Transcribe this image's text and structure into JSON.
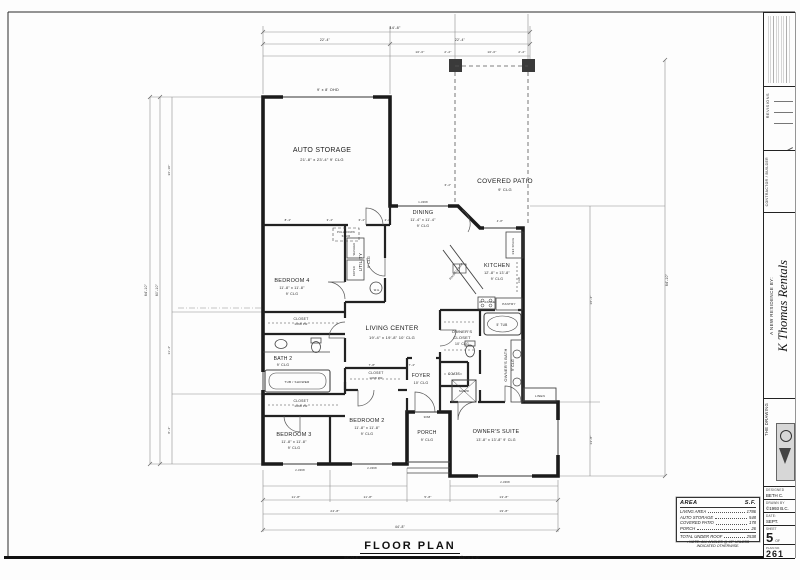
{
  "sheet": {
    "title": "FLOOR PLAN",
    "scale_label": "SCALE:",
    "scale_value": "1/4\" = 1'-0\""
  },
  "title_block": {
    "revisions_label": "REVISIONS",
    "contractor_label": "CONTRACTOR / BUILDER",
    "residence_by": "A NEW RESIDENCE BY:",
    "client_name": "K Thomas Rentals",
    "firm_label_line1": "THE",
    "firm_label_line2": "DRAWING",
    "designed_label": "DESIGNED",
    "designed_value": "BETH C.",
    "drawn_label": "DRAWN BY",
    "drawn_value": "©1993 B.C.",
    "date_label": "DATE:",
    "date_value": "SEPT.",
    "sheet_label": "SHEET",
    "sheet_number": "5",
    "sheet_of": "OF",
    "plan_no_label": "PLAN NO.",
    "plan_no_value": "261"
  },
  "area_table": {
    "title": "AREA",
    "unit": "S.F.",
    "rows": [
      {
        "label": "LIVING AREA",
        "value": "1786"
      },
      {
        "label": "AUTO STORAGE",
        "value": "548"
      },
      {
        "label": "COVERED PATIO",
        "value": "178"
      },
      {
        "label": "PORCH",
        "value": "26"
      },
      {
        "label": "TOTAL UNDER ROOF",
        "value": "2538",
        "total": true
      }
    ],
    "note_line1": "• NOTE:  ALL ANGLES @ 45° UNLESS",
    "note_line2": "INDICATED OTHERWISE."
  },
  "plan": {
    "labels": [
      {
        "t": "AUTO STORAGE",
        "x": 322,
        "y": 152,
        "s": 7
      },
      {
        "t": "21'-8\" x 23'-4\"      9' CLG",
        "x": 322,
        "y": 161,
        "s": 4
      },
      {
        "t": "9' x 8' OHD",
        "x": 328,
        "y": 91,
        "s": 3.8
      },
      {
        "t": "COVERED PATIO",
        "x": 505,
        "y": 183,
        "s": 6.5
      },
      {
        "t": "9' CLG",
        "x": 505,
        "y": 191,
        "s": 4
      },
      {
        "t": "DINING",
        "x": 423,
        "y": 214,
        "s": 5.5
      },
      {
        "t": "11'-4\" x 11'-4\"",
        "x": 423,
        "y": 221,
        "s": 3.6
      },
      {
        "t": "9' CLG",
        "x": 423,
        "y": 227,
        "s": 3.6
      },
      {
        "t": "KITCHEN",
        "x": 497,
        "y": 267,
        "s": 5.5
      },
      {
        "t": "12'-8\" x 13'-8\"",
        "x": 497,
        "y": 274,
        "s": 3.6
      },
      {
        "t": "9' CLG",
        "x": 497,
        "y": 280,
        "s": 3.6
      },
      {
        "t": "BEDROOM 4",
        "x": 292,
        "y": 282,
        "s": 5.5
      },
      {
        "t": "11'-8\" x 11'-8\"",
        "x": 292,
        "y": 289,
        "s": 3.6
      },
      {
        "t": "9' CLG",
        "x": 292,
        "y": 295,
        "s": 3.6
      },
      {
        "t": "UTILITY",
        "x": 362,
        "y": 262,
        "s": 4.5,
        "r": -90
      },
      {
        "t": "9' CLG",
        "x": 370,
        "y": 262,
        "s": 3.4,
        "r": -90
      },
      {
        "t": "PULL-DOWN",
        "x": 346,
        "y": 233,
        "s": 2.6
      },
      {
        "t": "STAIR",
        "x": 346,
        "y": 237,
        "s": 2.6
      },
      {
        "t": "LIVING CENTER",
        "x": 392,
        "y": 330,
        "s": 6.5
      },
      {
        "t": "19'-4\" x 19'-8\"      10' CLG",
        "x": 392,
        "y": 339,
        "s": 4
      },
      {
        "t": "OWNER'S",
        "x": 462,
        "y": 333,
        "s": 4
      },
      {
        "t": "CLOSET",
        "x": 462,
        "y": 339,
        "s": 4
      },
      {
        "t": "10' CLG",
        "x": 462,
        "y": 345,
        "s": 3.4
      },
      {
        "t": "OWNER'S BATH",
        "x": 507,
        "y": 365,
        "s": 4,
        "r": -90
      },
      {
        "t": "9' CLG",
        "x": 514,
        "y": 365,
        "s": 3.4,
        "r": -90
      },
      {
        "t": "5' TUB",
        "x": 502,
        "y": 326,
        "s": 3.2
      },
      {
        "t": "SHWR",
        "x": 464,
        "y": 392,
        "s": 3
      },
      {
        "t": "LINEN",
        "x": 540,
        "y": 397,
        "s": 3
      },
      {
        "t": "BATH 2",
        "x": 283,
        "y": 360,
        "s": 5
      },
      {
        "t": "9' CLG",
        "x": 283,
        "y": 366,
        "s": 3.6
      },
      {
        "t": "TUB / SHOWER",
        "x": 297,
        "y": 383,
        "s": 3
      },
      {
        "t": "CLOSET",
        "x": 301,
        "y": 320,
        "s": 3.4
      },
      {
        "t": "1068 PR",
        "x": 301,
        "y": 325,
        "s": 3
      },
      {
        "t": "CLOSET",
        "x": 301,
        "y": 402,
        "s": 3.4
      },
      {
        "t": "1068 PR",
        "x": 301,
        "y": 407,
        "s": 3
      },
      {
        "t": "CLOSET",
        "x": 376,
        "y": 374,
        "s": 3.4
      },
      {
        "t": "1068 PR",
        "x": 376,
        "y": 379,
        "s": 3
      },
      {
        "t": "COATS",
        "x": 454,
        "y": 375,
        "s": 3.2
      },
      {
        "t": "FOYER",
        "x": 421,
        "y": 377,
        "s": 5
      },
      {
        "t": "10' CLG",
        "x": 421,
        "y": 384,
        "s": 3.6
      },
      {
        "t": "BEDROOM 3",
        "x": 294,
        "y": 436,
        "s": 5.5
      },
      {
        "t": "11'-8\" x 11'-8\"",
        "x": 294,
        "y": 443,
        "s": 3.6
      },
      {
        "t": "9' CLG",
        "x": 294,
        "y": 449,
        "s": 3.6
      },
      {
        "t": "BEDROOM 2",
        "x": 367,
        "y": 422,
        "s": 5.5
      },
      {
        "t": "11'-8\" x 11'-8\"",
        "x": 367,
        "y": 429,
        "s": 3.6
      },
      {
        "t": "9' CLG",
        "x": 367,
        "y": 435,
        "s": 3.6
      },
      {
        "t": "PORCH",
        "x": 427,
        "y": 434,
        "s": 5
      },
      {
        "t": "9' CLG",
        "x": 427,
        "y": 441,
        "s": 3.6
      },
      {
        "t": "OWNER'S SUITE",
        "x": 496,
        "y": 433,
        "s": 5.5
      },
      {
        "t": "13'-8\" x 13'-8\"      9' CLG",
        "x": 496,
        "y": 441,
        "s": 3.6
      },
      {
        "t": "RAISED BAR",
        "x": 457,
        "y": 272,
        "s": 3,
        "r": -52
      },
      {
        "t": "30\" RANGE",
        "x": 487,
        "y": 303,
        "s": 2.6
      },
      {
        "t": "PANTRY",
        "x": 509,
        "y": 305,
        "s": 3
      },
      {
        "t": "REF SPACE",
        "x": 514,
        "y": 246,
        "s": 2.6,
        "r": -90
      },
      {
        "t": "CAB",
        "x": 520,
        "y": 280,
        "s": 2.6,
        "r": -90
      },
      {
        "t": "WASHER",
        "x": 355,
        "y": 249,
        "s": 2.6,
        "r": -90
      },
      {
        "t": "DRYER",
        "x": 355,
        "y": 271,
        "s": 2.6,
        "r": -90
      },
      {
        "t": "W.H.",
        "x": 377,
        "y": 291,
        "s": 2.6
      },
      {
        "t": "44'-8\"",
        "x": 395,
        "y": 29,
        "s": 3.8
      },
      {
        "t": "22'-4\"",
        "x": 325,
        "y": 41,
        "s": 3.4
      },
      {
        "t": "22'-4\"",
        "x": 460,
        "y": 41,
        "s": 3.4
      },
      {
        "t": "10'-0\"",
        "x": 420,
        "y": 53,
        "s": 3
      },
      {
        "t": "2'-2\"",
        "x": 448,
        "y": 53,
        "s": 3
      },
      {
        "t": "10'-0\"",
        "x": 492,
        "y": 53,
        "s": 3
      },
      {
        "t": "2'-2\"",
        "x": 522,
        "y": 53,
        "s": 3
      },
      {
        "t": "8'-4\"",
        "x": 288,
        "y": 221,
        "s": 2.8
      },
      {
        "t": "3'-4\"",
        "x": 330,
        "y": 221,
        "s": 2.8
      },
      {
        "t": "6'-4\"",
        "x": 362,
        "y": 221,
        "s": 2.8
      },
      {
        "t": "2'-8\"",
        "x": 388,
        "y": 221,
        "s": 2.8
      },
      {
        "t": "64'-10\"",
        "x": 147,
        "y": 290,
        "s": 3.4,
        "r": -90
      },
      {
        "t": "60'-10\"",
        "x": 158,
        "y": 290,
        "s": 3.4,
        "r": -90
      },
      {
        "t": "36'-10\"",
        "x": 170,
        "y": 170,
        "s": 3,
        "r": -90
      },
      {
        "t": "11'-4\"",
        "x": 170,
        "y": 350,
        "s": 3,
        "r": -90
      },
      {
        "t": "8'-4\"",
        "x": 170,
        "y": 430,
        "s": 3,
        "r": -90
      },
      {
        "t": "64'-10\"",
        "x": 668,
        "y": 280,
        "s": 3.4,
        "r": -90
      },
      {
        "t": "16'-4\"",
        "x": 592,
        "y": 300,
        "s": 3,
        "r": -90
      },
      {
        "t": "13'-8\"",
        "x": 592,
        "y": 440,
        "s": 3,
        "r": -90
      },
      {
        "t": "6'-2\"",
        "x": 448,
        "y": 186,
        "s": 2.8
      },
      {
        "t": "4'-8\"",
        "x": 500,
        "y": 222,
        "s": 2.6
      },
      {
        "t": "7'-8\"",
        "x": 372,
        "y": 366,
        "s": 2.8
      },
      {
        "t": "7'-4\"",
        "x": 412,
        "y": 366,
        "s": 2.8
      },
      {
        "t": "11'-8\"",
        "x": 296,
        "y": 498,
        "s": 3
      },
      {
        "t": "11'-8\"",
        "x": 368,
        "y": 498,
        "s": 3
      },
      {
        "t": "5'-8\"",
        "x": 428,
        "y": 498,
        "s": 3
      },
      {
        "t": "13'-8\"",
        "x": 504,
        "y": 498,
        "s": 3
      },
      {
        "t": "24'-8\"",
        "x": 335,
        "y": 512,
        "s": 3
      },
      {
        "t": "19'-8\"",
        "x": 504,
        "y": 512,
        "s": 3
      },
      {
        "t": "44'-8\"",
        "x": 400,
        "y": 528,
        "s": 3.4
      },
      {
        "t": "2-3068",
        "x": 300,
        "y": 471,
        "s": 2.6
      },
      {
        "t": "2-3068",
        "x": 372,
        "y": 469,
        "s": 2.6
      },
      {
        "t": "2-3068",
        "x": 505,
        "y": 483,
        "s": 2.6
      },
      {
        "t": "1-3068",
        "x": 423,
        "y": 203,
        "s": 2.6
      },
      {
        "t": "3068",
        "x": 427,
        "y": 418,
        "s": 2.6
      }
    ]
  }
}
